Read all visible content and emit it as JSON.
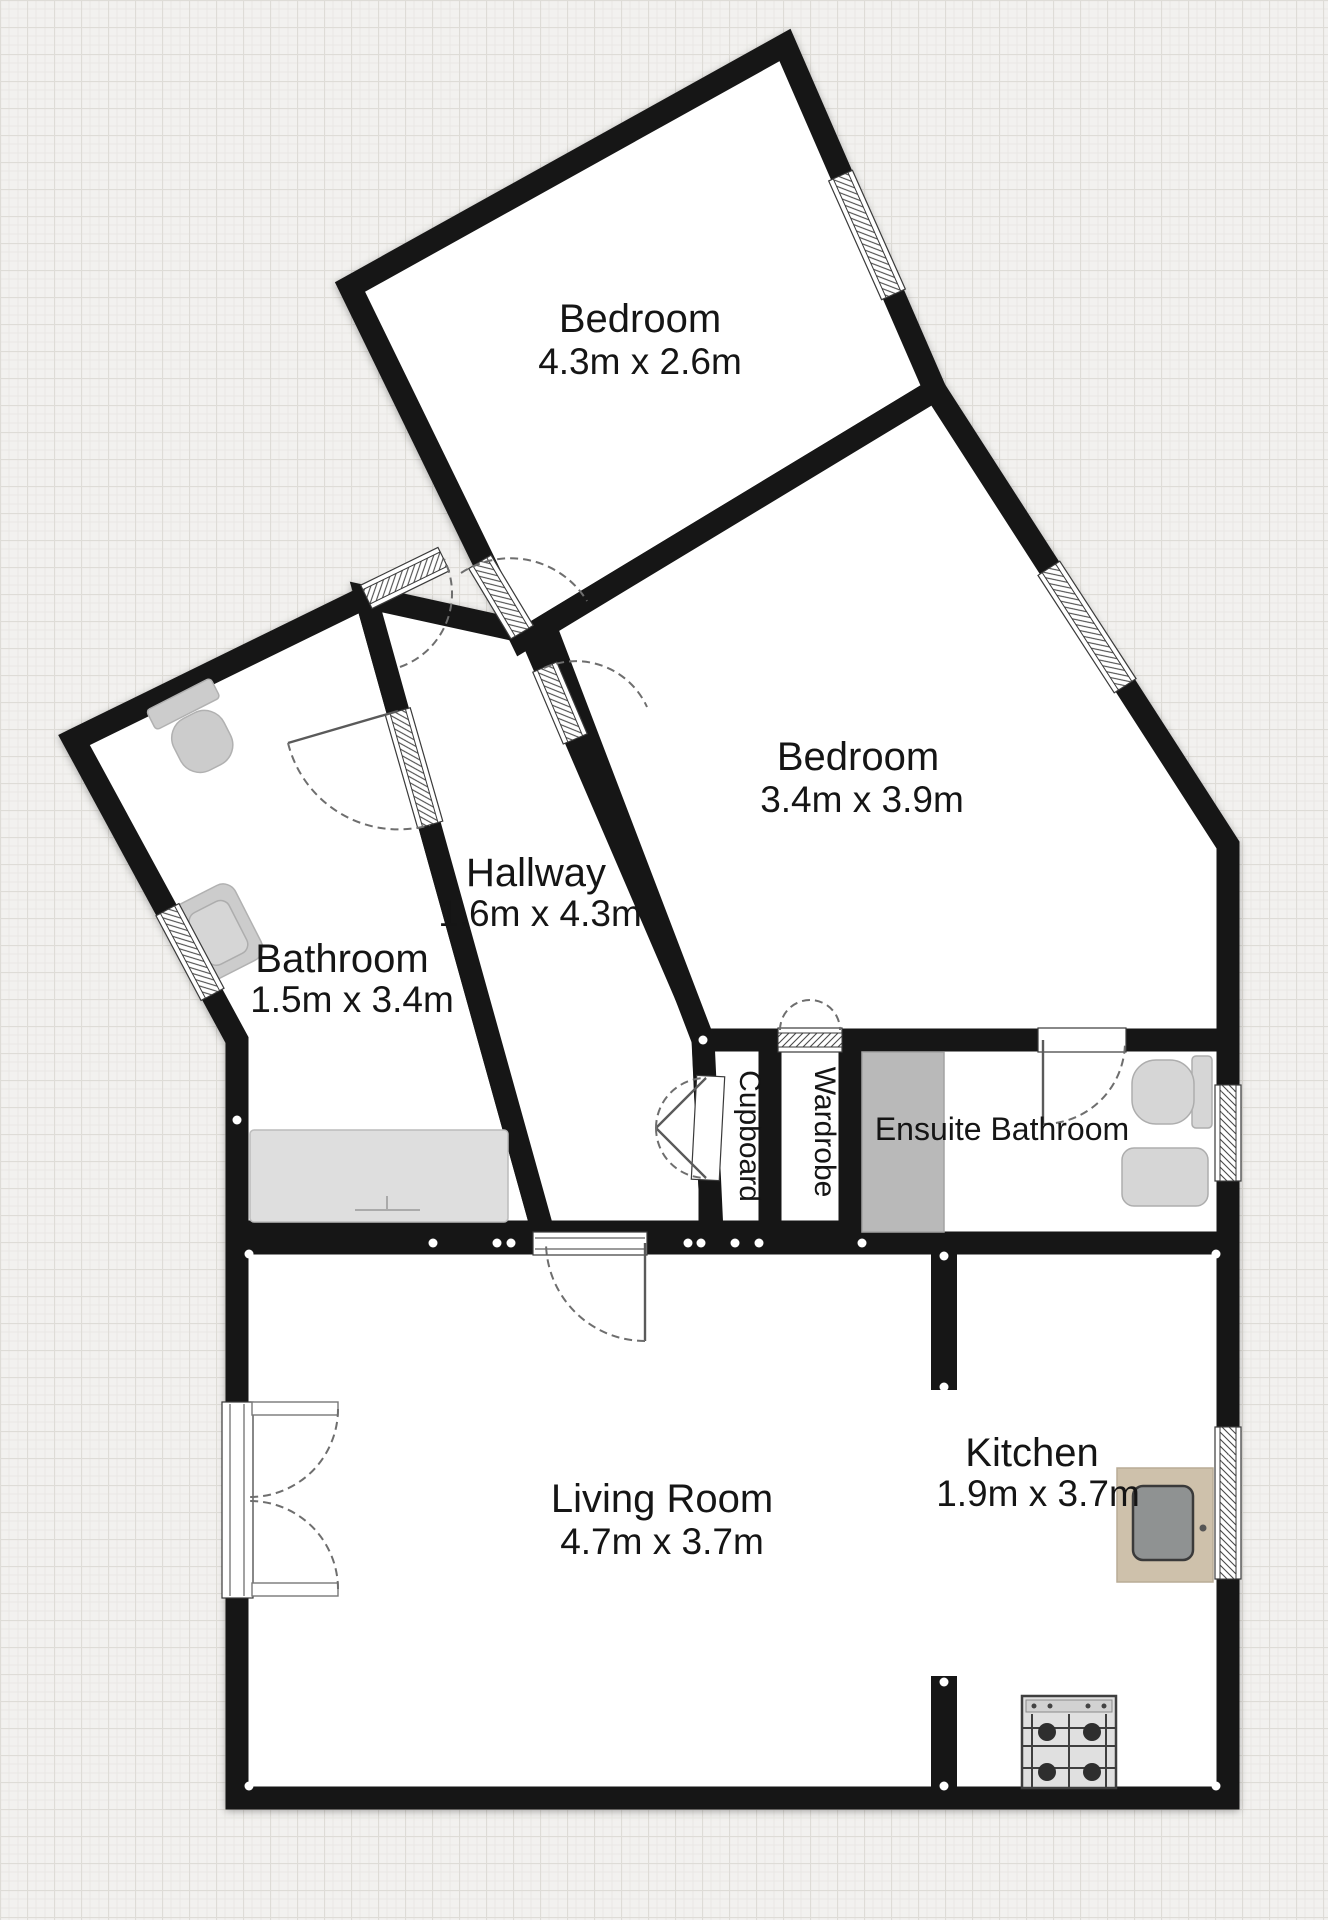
{
  "rooms": [
    {
      "id": "bedroom-1",
      "name": "Bedroom",
      "dims": "4.3m x 2.6m"
    },
    {
      "id": "bedroom-2",
      "name": "Bedroom",
      "dims": "3.4m x 3.9m"
    },
    {
      "id": "hallway",
      "name": "Hallway",
      "dims": "1.6m x 4.3m"
    },
    {
      "id": "bathroom",
      "name": "Bathroom",
      "dims": "1.5m x 3.4m"
    },
    {
      "id": "ensuite",
      "name": "Ensuite Bathroom"
    },
    {
      "id": "cupboard",
      "name": "Cupboard"
    },
    {
      "id": "wardrobe",
      "name": "Wardrobe"
    },
    {
      "id": "living-room",
      "name": "Living Room",
      "dims": "4.7m x 3.7m"
    },
    {
      "id": "kitchen",
      "name": "Kitchen",
      "dims": "1.9m x 3.7m"
    }
  ],
  "fixtures": [
    "toilet",
    "sink",
    "bathtub",
    "shower",
    "toilet",
    "sink",
    "kitchen-sink",
    "stove"
  ],
  "colors": {
    "wall": "#171717",
    "room_fill": "#ffffff",
    "fixture": "#cccccc",
    "shower": "#b9b9b9",
    "tub": "#dedede",
    "counter": "#cec1ab",
    "basin": "#8f9292",
    "background": "#f2f1ef",
    "text": "#151515"
  }
}
